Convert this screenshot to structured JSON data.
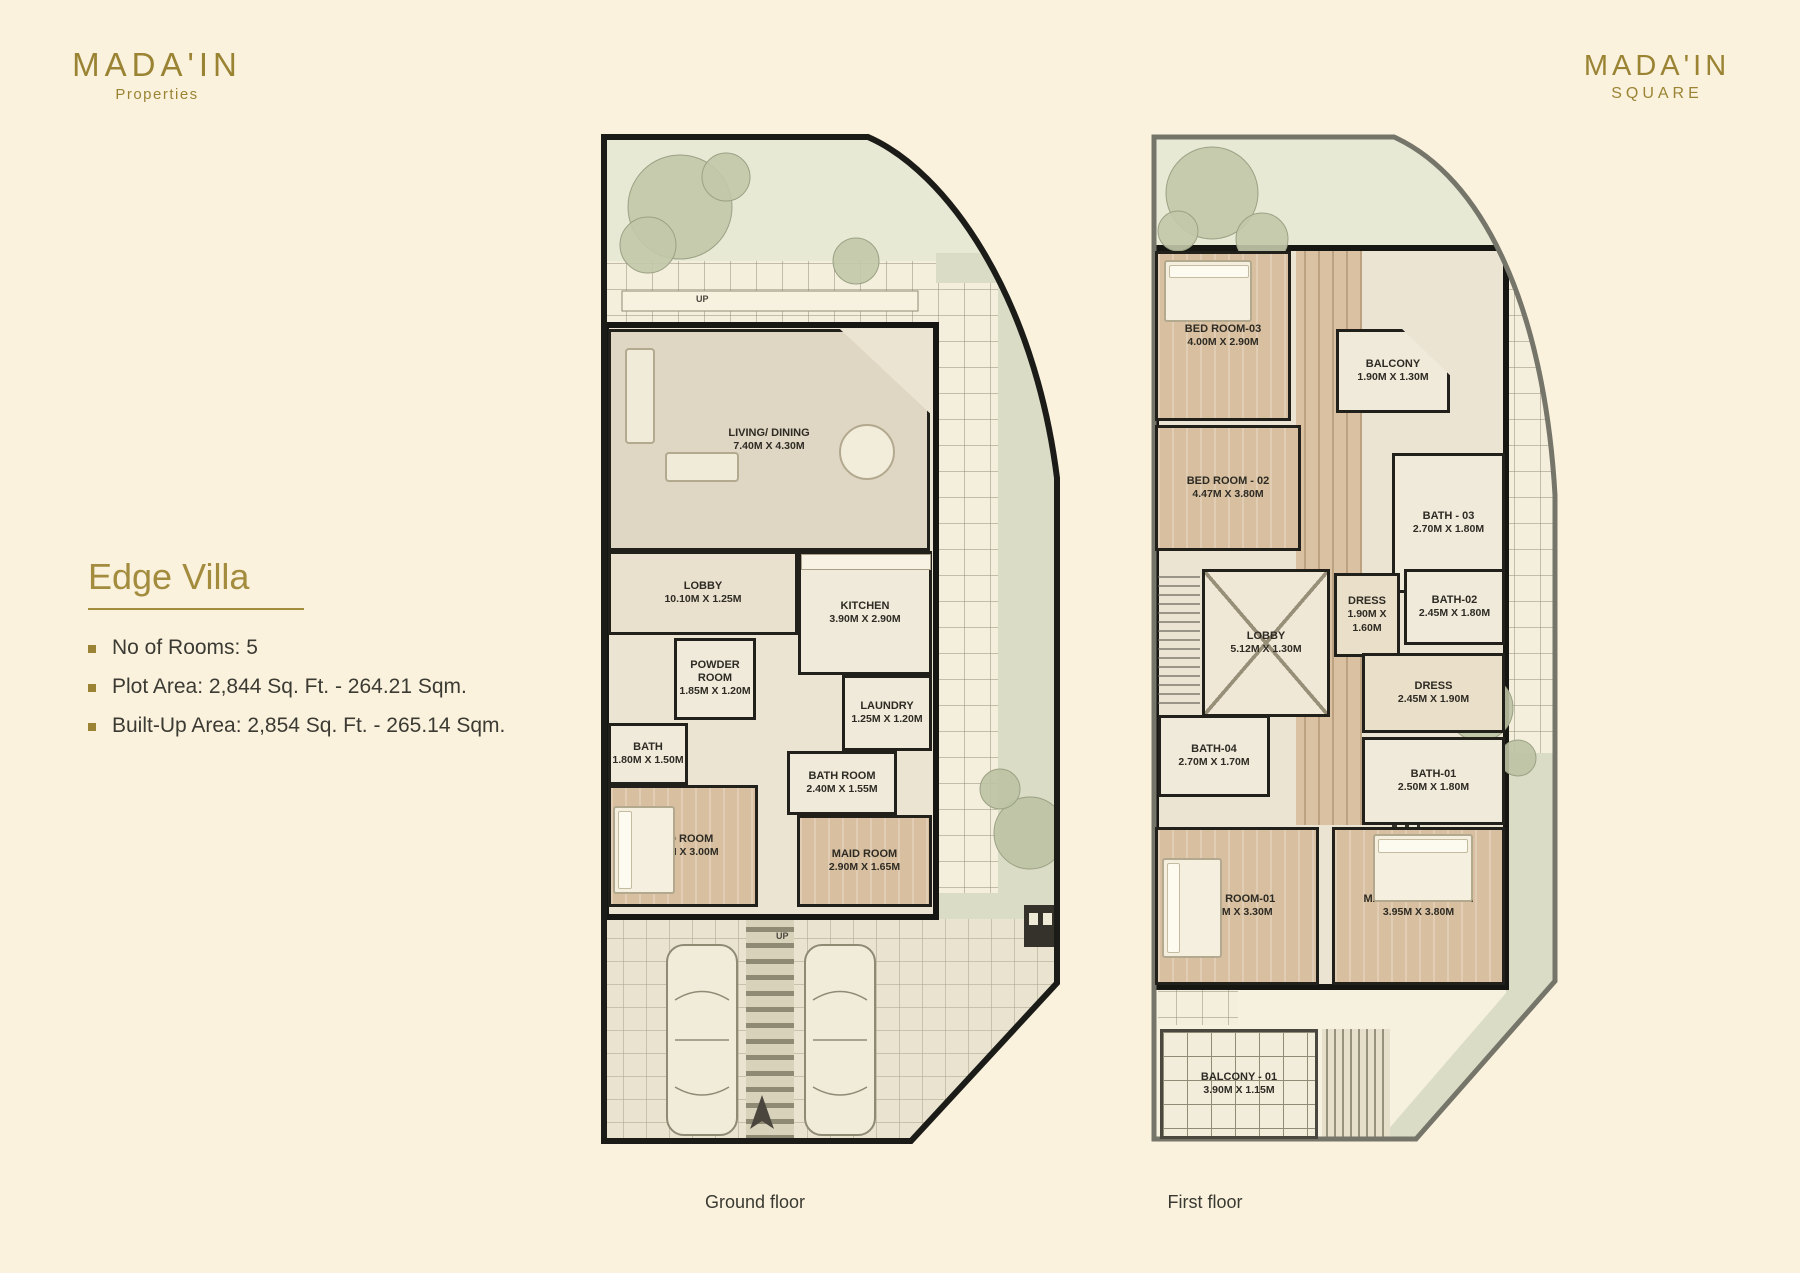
{
  "page": {
    "background": "#FBF2DE",
    "accent_gold": "#9A8434",
    "text_dark": "#3B3B33"
  },
  "brand_left": {
    "name": "MADA'IN",
    "tagline": "Properties"
  },
  "brand_right": {
    "name": "MADA'IN",
    "tagline": "SQUARE"
  },
  "info": {
    "title": "Edge Villa",
    "bullets": [
      "No of Rooms: 5",
      "Plot Area: 2,844 Sq. Ft. - 264.21 Sqm.",
      "Built-Up Area: 2,854 Sq. Ft. - 265.14 Sqm."
    ]
  },
  "ground": {
    "caption": "Ground floor",
    "up_label": "UP",
    "rooms": [
      {
        "name": "LIVING/ DINING",
        "dims": "7.40M X 4.30M"
      },
      {
        "name": "LOBBY",
        "dims": "10.10M X 1.25M"
      },
      {
        "name": "KITCHEN",
        "dims": "3.90M X 2.90M"
      },
      {
        "name": "POWDER ROOM",
        "dims": "1.85M X 1.20M"
      },
      {
        "name": "BATH",
        "dims": "1.80M X 1.50M"
      },
      {
        "name": "LAUNDRY",
        "dims": "1.25M X 1.20M"
      },
      {
        "name": "BATH ROOM",
        "dims": "2.40M X 1.55M"
      },
      {
        "name": "BED ROOM",
        "dims": "3.45M X 3.00M"
      },
      {
        "name": "MAID ROOM",
        "dims": "2.90M X 1.65M"
      }
    ]
  },
  "first": {
    "caption": "First floor",
    "rooms": [
      {
        "name": "BED ROOM-03",
        "dims": "4.00M X 2.90M"
      },
      {
        "name": "BALCONY",
        "dims": "1.90M X 1.30M"
      },
      {
        "name": "BED ROOM - 02",
        "dims": "4.47M X 3.80M"
      },
      {
        "name": "BATH - 03",
        "dims": "2.70M X 1.80M"
      },
      {
        "name": "LOBBY",
        "dims": "5.12M X 1.30M"
      },
      {
        "name": "DRESS",
        "dims": "1.90M X 1.60M"
      },
      {
        "name": "BATH-02",
        "dims": "2.45M X 1.80M"
      },
      {
        "name": "DRESS",
        "dims": "2.45M X 1.90M"
      },
      {
        "name": "BATH-04",
        "dims": "2.70M X 1.70M"
      },
      {
        "name": "BATH-01",
        "dims": "2.50M X 1.80M"
      },
      {
        "name": "BED ROOM-01",
        "dims": "4.00M X 3.30M"
      },
      {
        "name": "MASTER BED ROOM",
        "dims": "3.95M X 3.80M"
      },
      {
        "name": "BALCONY - 01",
        "dims": "3.90M X 1.15M"
      }
    ]
  }
}
